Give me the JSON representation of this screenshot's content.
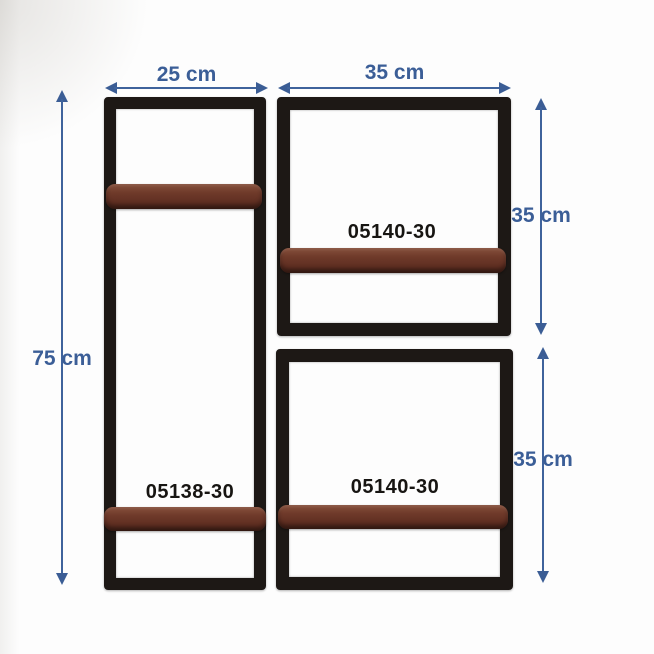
{
  "palette": {
    "background": "#fdfdfd",
    "dimension_blue": "#3b5e97",
    "frame_black": "#1d1815",
    "wood_brown": "#6f3a2a",
    "code_black": "#171512"
  },
  "shelves": {
    "tall": {
      "code": "05138-30",
      "width_label": "25 cm",
      "height_label": "75 cm"
    },
    "top_right": {
      "code": "05140-30",
      "width_label": "35 cm",
      "height_label": "35 cm"
    },
    "bottom_right": {
      "code": "05140-30",
      "height_label": "35 cm"
    }
  }
}
